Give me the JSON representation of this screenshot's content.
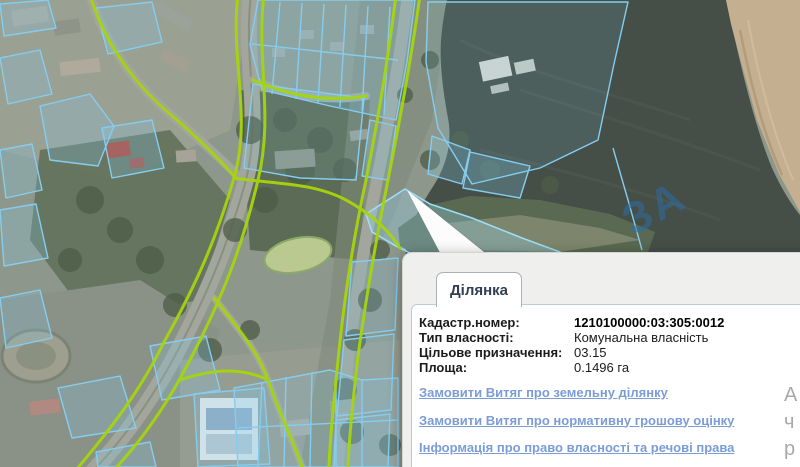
{
  "map": {
    "watermark_text": "ЗА",
    "colors": {
      "parcel_outline": "#85cdf0",
      "road_outline": "#a6d50d",
      "water": "#454f48",
      "sand": "#c4af90"
    }
  },
  "popup": {
    "tab_label": "Ділянка",
    "fields": [
      {
        "label": "Кадастр.номер:",
        "value": "1210100000:03:305:0012"
      },
      {
        "label": "Тип власності:",
        "value": "Комунальна власність"
      },
      {
        "label": "Цільове призначення:",
        "value": "03.15"
      },
      {
        "label": "Площа:",
        "value": "0.1496 га"
      }
    ],
    "links": [
      "Замовити Витяг про земельну ділянку",
      "Замовити Витяг про нормативну грошову оцінку",
      "Інформація про право власності та речові права"
    ],
    "clipped_fragments": [
      "А",
      "ч",
      "р"
    ]
  }
}
